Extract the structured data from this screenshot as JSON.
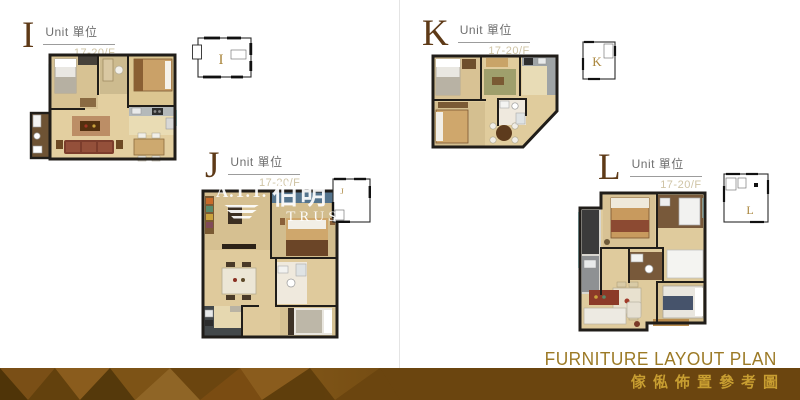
{
  "units": [
    {
      "letter": "I",
      "unit_text": "Unit 單位",
      "floor_text": "17-20/F",
      "key_letter": "I"
    },
    {
      "letter": "J",
      "unit_text": "Unit 單位",
      "floor_text": "17-20/F",
      "key_letter": "J"
    },
    {
      "letter": "K",
      "unit_text": "Unit 單位",
      "floor_text": "17-20/F",
      "key_letter": "K"
    },
    {
      "letter": "L",
      "unit_text": "Unit 單位",
      "floor_text": "17-20/F",
      "key_letter": "L"
    }
  ],
  "watermark": {
    "line1": "A.T.T.",
    "cjk": "伯明",
    "line2": "TRUS"
  },
  "footer": {
    "title_en": "FURNITURE LAYOUT PLAN",
    "title_zh": "傢俬佈置參考圖"
  },
  "colors": {
    "band": "#6b450f",
    "title_en": "#9c7a26",
    "title_zh": "#c89e31",
    "unit_letter": "#5e3a17",
    "key_letter": "#a9853b",
    "floor_text": "#cfc4a5",
    "wall": "#201d19",
    "floor_wood": "#e0cc9d",
    "window": "#a8dcdf"
  }
}
